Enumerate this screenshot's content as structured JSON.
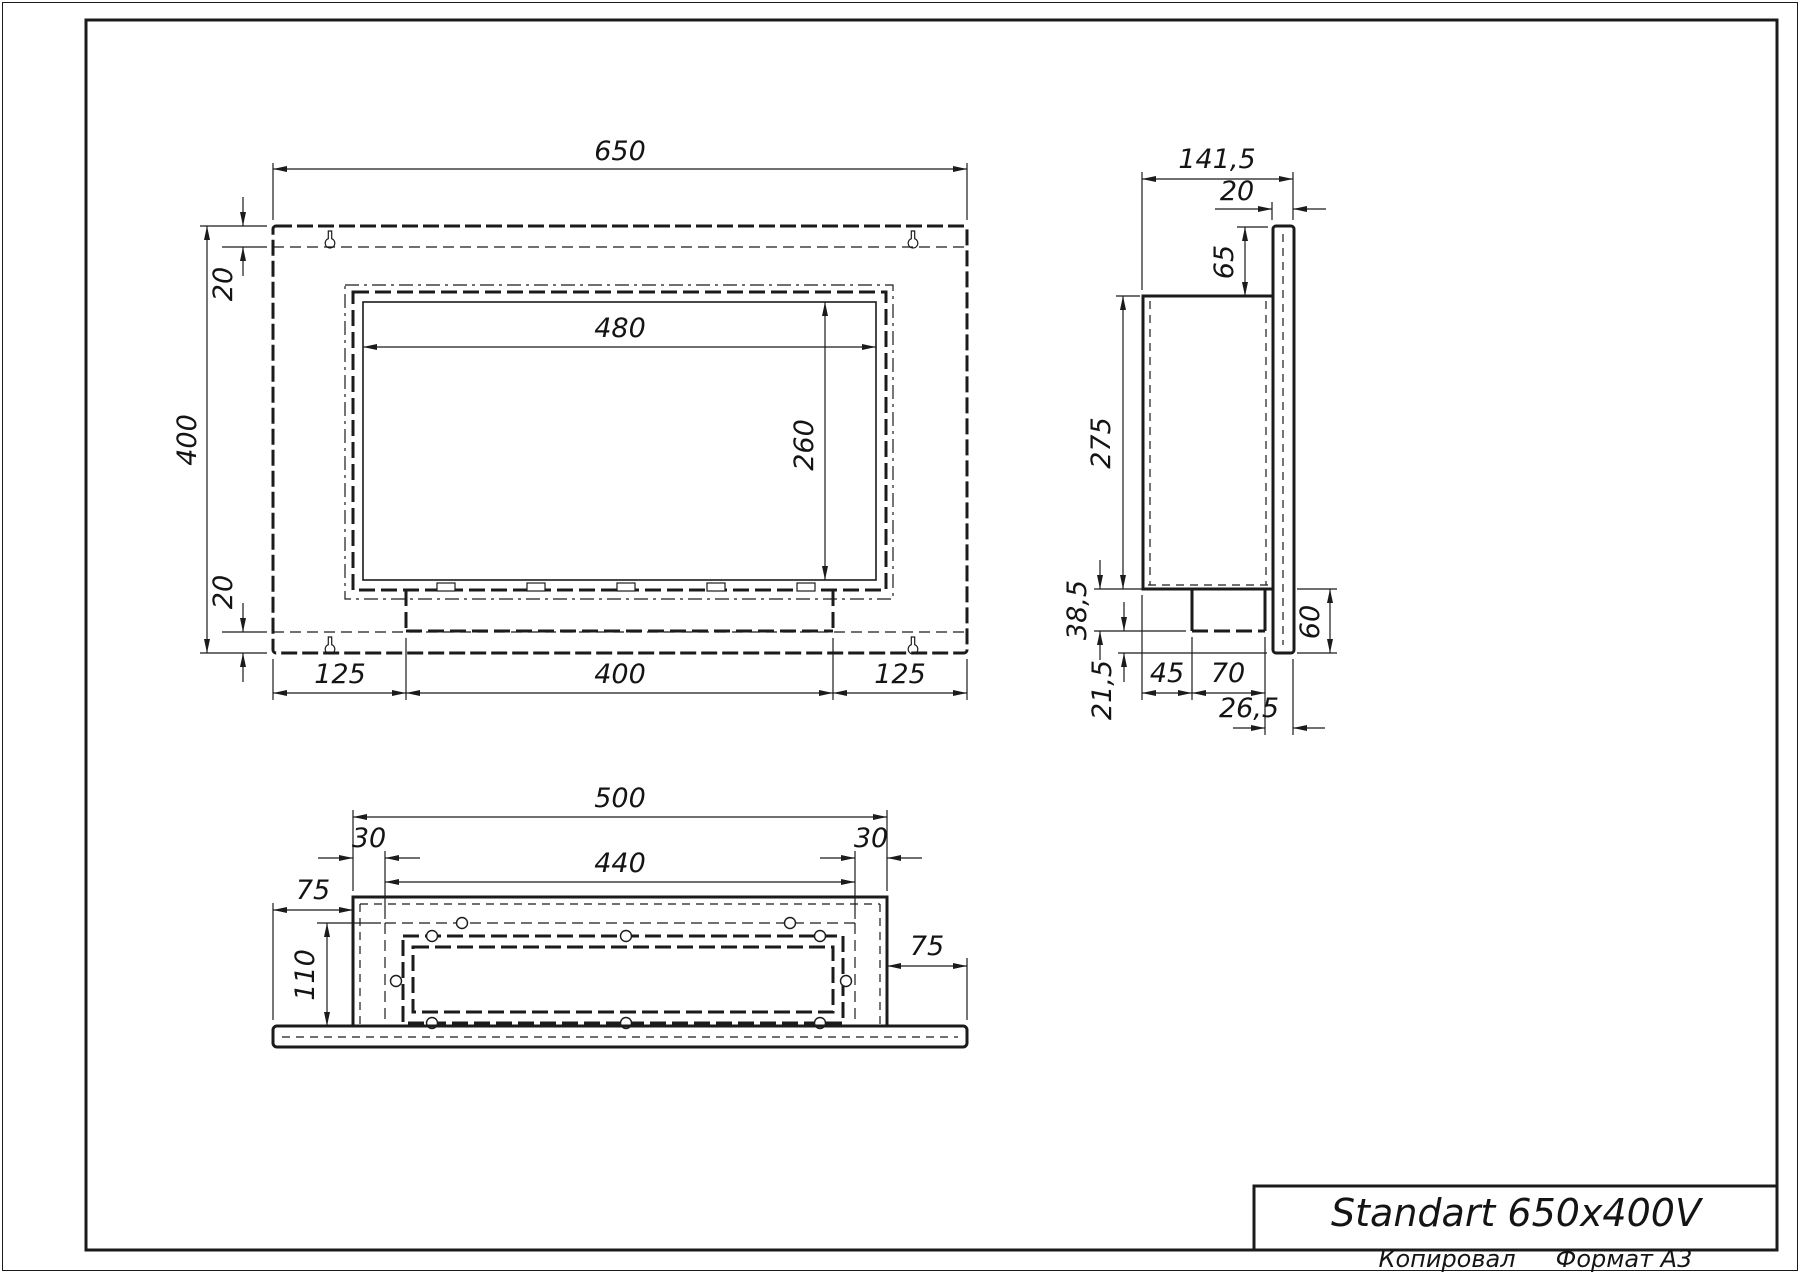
{
  "front_view": {
    "dims": {
      "overall_width": "650",
      "overall_height": "400",
      "top_margin": "20",
      "bottom_margin": "20",
      "opening_width": "480",
      "opening_height": "260",
      "bottom_left_segment": "125",
      "bottom_center_segment": "400",
      "bottom_right_segment": "125"
    }
  },
  "side_view": {
    "dims": {
      "overall_depth": "141,5",
      "panel_thickness": "20",
      "panel_top_to_box": "65",
      "box_height": "275",
      "box_bottom_drop": "38,5",
      "drop_to_panel_bottom": "21,5",
      "burner_offset": "45",
      "burner_depth": "70",
      "burner_to_panel_edge": "26,5",
      "panel_bottom_height": "60"
    }
  },
  "bottom_view": {
    "dims": {
      "box_width": "500",
      "left_margin": "30",
      "right_margin": "30",
      "opening_width": "440",
      "left_flange": "75",
      "right_flange": "75",
      "opening_depth": "110"
    }
  },
  "title_block": {
    "title": "Standart 650x400V"
  },
  "footer": {
    "copied_label": "Копировал",
    "format_label": "Формат А3"
  }
}
